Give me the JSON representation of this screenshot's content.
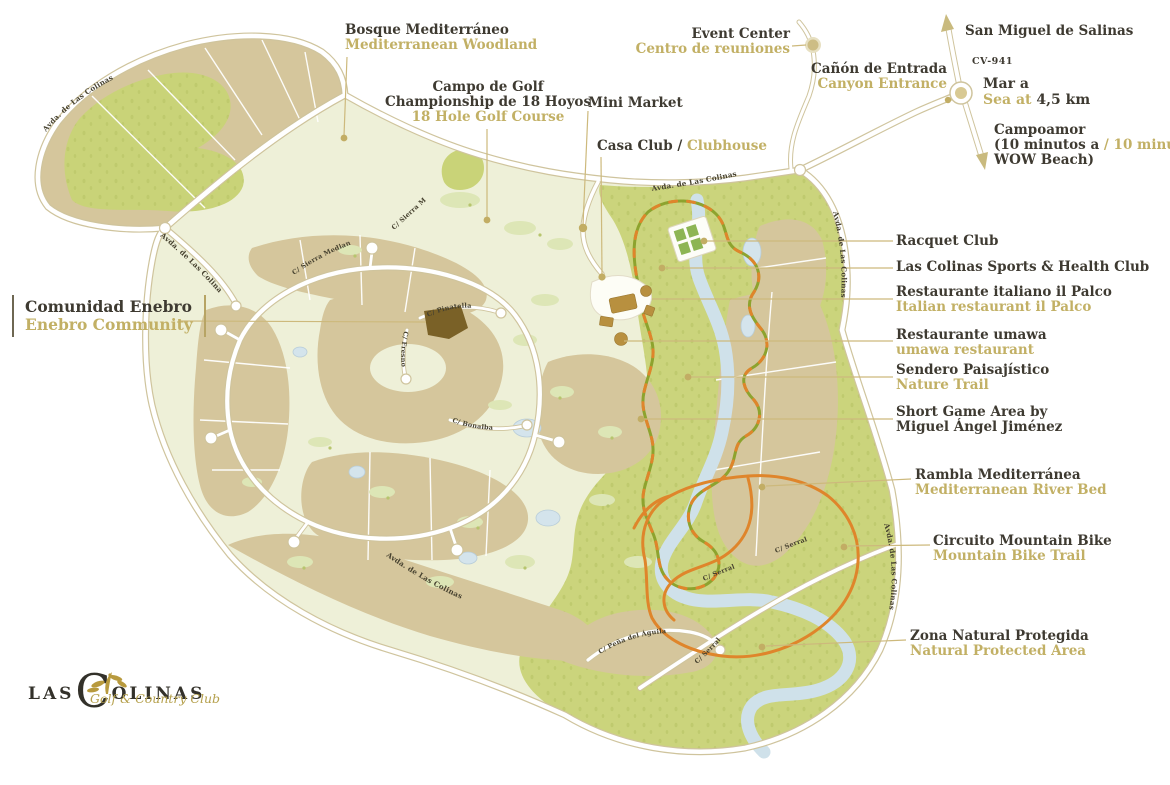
{
  "brand": {
    "word1": "LAS",
    "initial": "C",
    "word2": "OLINAS",
    "tagline": "Golf & Country Club"
  },
  "colors": {
    "label_dark": "#3e3a31",
    "label_gold": "#c2b065",
    "parcel_tan": "#d5c69c",
    "golf_pale_green": "#eef0d8",
    "nature_green": "#cbd47c",
    "river_blue": "#cfe1ea",
    "trail_olive": "#8da32e",
    "trail_orange": "#df852b",
    "enebro_brown": "#7a6127"
  },
  "callouts": {
    "bosque": {
      "es": "Bosque Mediterráneo",
      "en": "Mediterranean Woodland"
    },
    "campo": {
      "es1": "Campo de Golf",
      "es2": "Championship de 18 Hoyos",
      "en": "18 Hole Golf Course"
    },
    "mini_market": {
      "label": "Mini Market"
    },
    "casa_club": {
      "es": "Casa Club /",
      "en": "Clubhouse"
    },
    "event_center": {
      "en": "Event Center",
      "es": "Centro de reuniones"
    },
    "canon": {
      "es": "Cañón de Entrada",
      "en": "Canyon Entrance"
    },
    "san_miguel": {
      "label": "San Miguel de Salinas"
    },
    "road_code": {
      "label": "CV-941"
    },
    "sea": {
      "es": "Mar a",
      "en": "Sea at",
      "distance": "4,5 km"
    },
    "campoamor": {
      "name": "Campoamor",
      "es": "(10 minutos a",
      "en": "/ 10 minutes to",
      "end": "WOW Beach)"
    },
    "racquet": {
      "label": "Racquet Club"
    },
    "sports": {
      "label": "Las Colinas Sports & Health Club"
    },
    "il_palco": {
      "es": "Restaurante italiano il Palco",
      "en": "Italian restaurant il Palco"
    },
    "umawa": {
      "es": "Restaurante umawa",
      "en": "umawa restaurant"
    },
    "sendero": {
      "es": "Sendero Paisajístico",
      "en": "Nature Trail"
    },
    "short_game": {
      "line1": "Short Game Area by",
      "line2": "Miguel Ángel Jiménez"
    },
    "rambla": {
      "es": "Rambla Mediterránea",
      "en": "Mediterranean River Bed"
    },
    "mtb": {
      "es": "Circuito Mountain Bike",
      "en": "Mountain Bike Trail"
    },
    "zona": {
      "es": "Zona Natural Protegida",
      "en": "Natural Protected Area"
    },
    "enebro": {
      "es": "Comunidad Enebro",
      "en": "Enebro Community"
    }
  },
  "roads": {
    "avda": "Avda. de Las Colinas",
    "serral": "C/ Serral",
    "aguila": "C/ Peña del Águila",
    "sierra": "C/ Sierra Mediana",
    "pinatella": "C/ Pinatella",
    "fresno": "C/ Fresno",
    "bonalba": "C/ Bonalba"
  }
}
